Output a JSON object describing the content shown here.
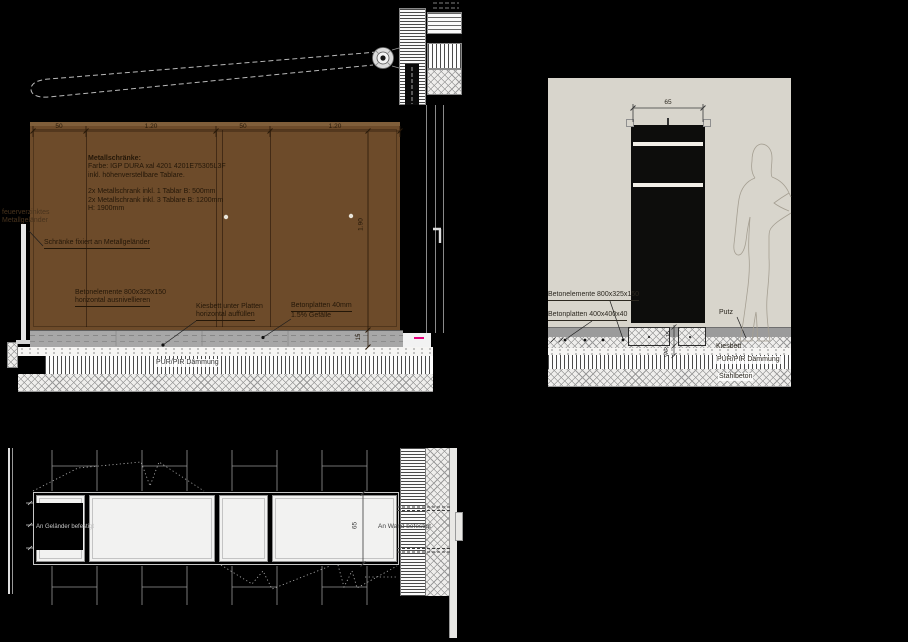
{
  "drawing": {
    "elevation": {
      "dims": {
        "d50a": "50",
        "d120a": "1.20",
        "d50b": "50",
        "d120b": "1.20",
        "d190": "1.90",
        "d15": "15"
      },
      "note": {
        "title": "Metallschränke:",
        "l1": "Farbe: IGP DURA xal 4201 4201E75305L3F",
        "l2": "inkl. höhenverstellbare Tablare.",
        "l3": "2x Metallschrank inkl. 1 Tablar B: 500mm",
        "l4": "2x Metallschrank inkl. 3 Tablare B: 1200mm",
        "l5": "H: 1900mm"
      },
      "labels": {
        "railing1": "feuerverzinktes",
        "railing2": "Metallgeländer",
        "fixed": "Schränke fixiert an Metallgeländer",
        "betonelemente1": "Betonelemente 800x325x150",
        "betonelemente2": "horizontal ausnivellieren",
        "kiesbett1": "Kiesbett unter Platten",
        "kiesbett2": "horizontal auffüllen",
        "betonplatten1": "Betonplatten 40mm",
        "betonplatten2": "1.5% Gefälle",
        "daemmung": "PUR/PIR Dämmung"
      }
    },
    "section": {
      "dims": {
        "d65": "65",
        "d15": "15",
        "dvar": "VAR"
      },
      "labels": {
        "betonelemente": "Betonelemente 800x325x150",
        "betonplatten": "Betonplatten 400x400x40",
        "putz": "Putz",
        "kiesbett": "Kiesbett",
        "daemmung": "PUR/PIR Dämmung",
        "stahlbeton": "Stahlbeton"
      }
    },
    "plan": {
      "dims": {
        "d65": "65"
      },
      "labels": {
        "left": "An Geländer befestigt",
        "right": "An Wand befestigt"
      }
    },
    "colors": {
      "background": "#000000",
      "cabinet_brown": "#6d4b2a",
      "wall_beige": "#d8d5cc",
      "concrete_gray": "#a7a7a7",
      "magenta_mark": "#e5007d"
    }
  }
}
